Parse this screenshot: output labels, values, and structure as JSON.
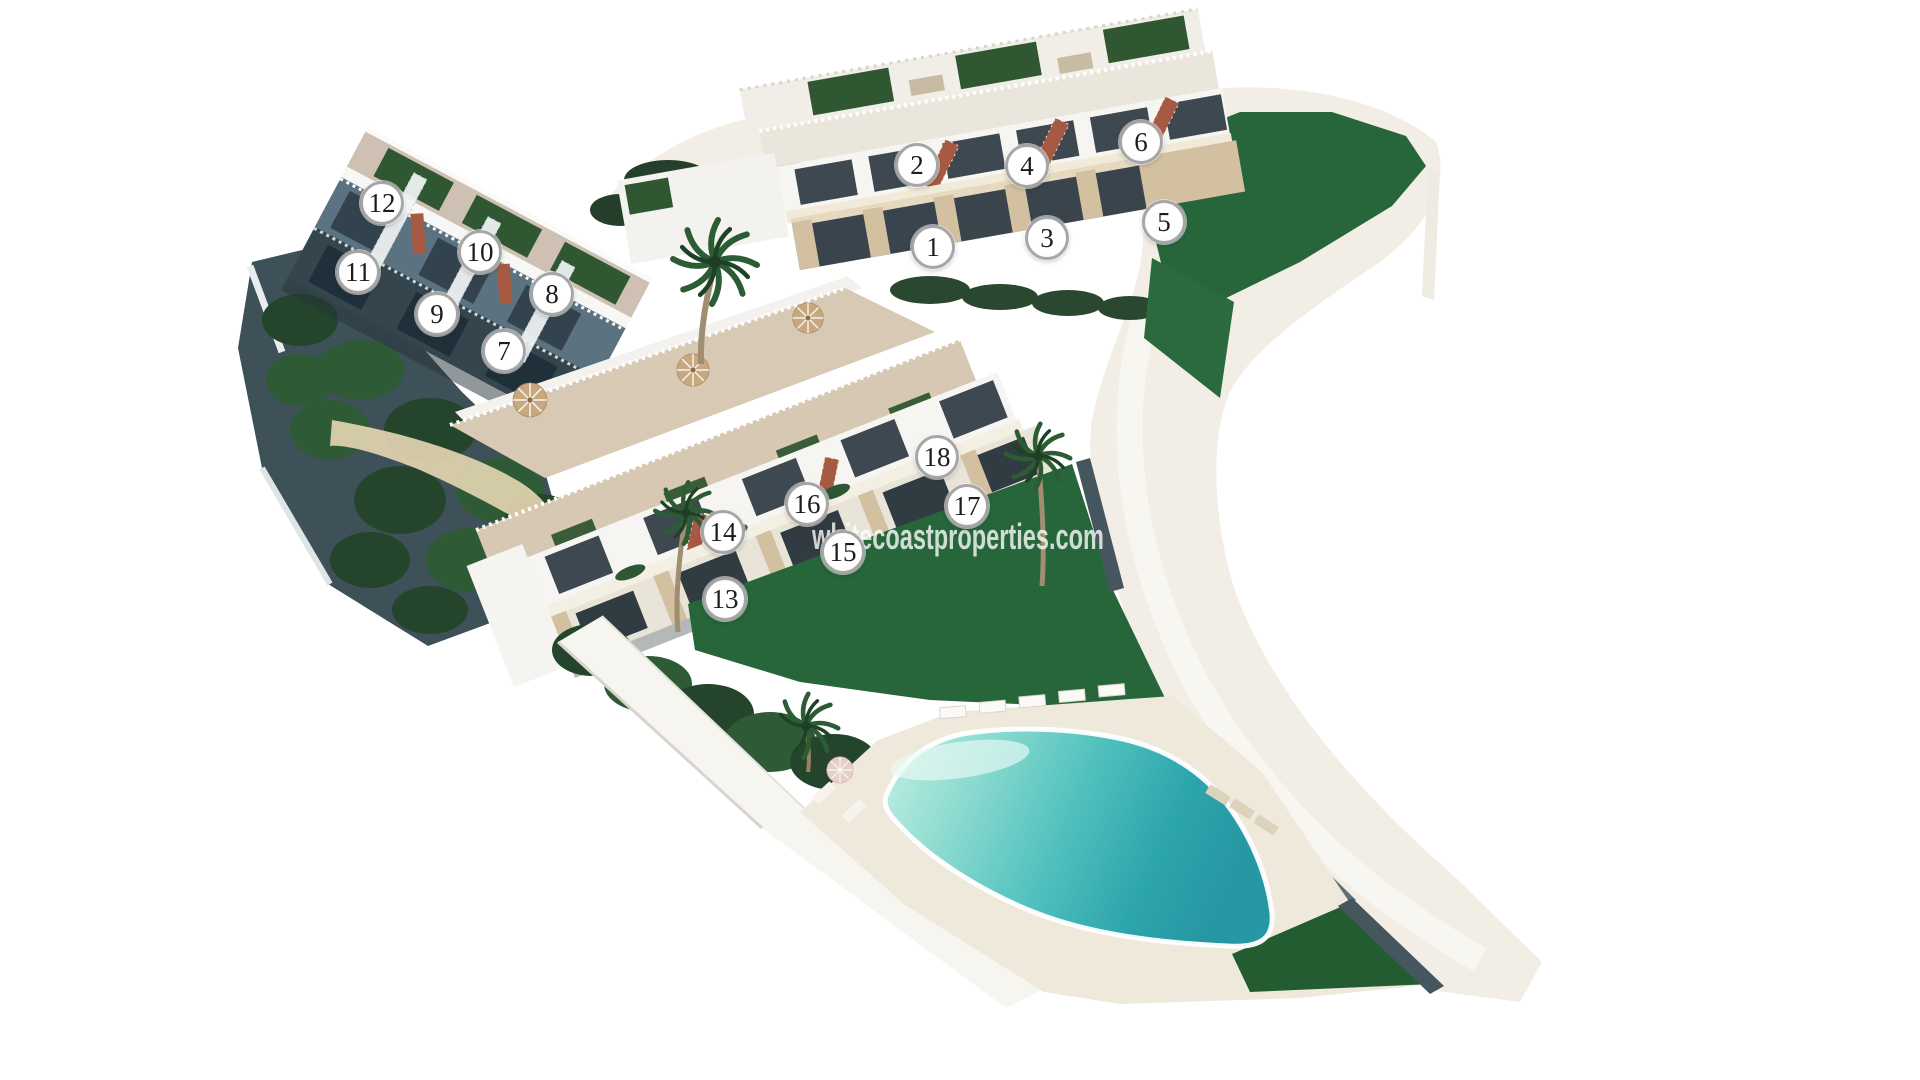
{
  "page": {
    "type": "aerial-3d-site-plan-render",
    "description": "Aerial 3D render of a hillside residential development with three terraced apartment blocks, 18 numbered units, gardens, palm trees, access road and communal swimming pool with sun deck"
  },
  "watermark": {
    "text": "whitecoastproperties.com"
  },
  "site_plan": {
    "unit_count": 18,
    "marker_diameter_px": 44,
    "units": [
      {
        "id": "1",
        "x": 933,
        "y": 247
      },
      {
        "id": "2",
        "x": 917,
        "y": 165
      },
      {
        "id": "3",
        "x": 1047,
        "y": 238
      },
      {
        "id": "4",
        "x": 1027,
        "y": 166
      },
      {
        "id": "5",
        "x": 1164,
        "y": 222
      },
      {
        "id": "6",
        "x": 1141,
        "y": 142
      },
      {
        "id": "7",
        "x": 504,
        "y": 351
      },
      {
        "id": "8",
        "x": 552,
        "y": 294
      },
      {
        "id": "9",
        "x": 437,
        "y": 314
      },
      {
        "id": "10",
        "x": 480,
        "y": 252
      },
      {
        "id": "11",
        "x": 358,
        "y": 272
      },
      {
        "id": "12",
        "x": 382,
        "y": 203
      },
      {
        "id": "13",
        "x": 725,
        "y": 599
      },
      {
        "id": "14",
        "x": 723,
        "y": 532
      },
      {
        "id": "15",
        "x": 843,
        "y": 552
      },
      {
        "id": "16",
        "x": 807,
        "y": 504
      },
      {
        "id": "17",
        "x": 967,
        "y": 506
      },
      {
        "id": "18",
        "x": 937,
        "y": 457
      }
    ],
    "features": [
      "block A units 1-6 (top right)",
      "block B units 7-12 (left)",
      "block C units 13-18 (center)",
      "communal swimming pool",
      "sun deck with loungers and parasols",
      "roof gardens",
      "lawns and hedges",
      "palm trees",
      "curved access road"
    ],
    "palette": {
      "background": "#ffffff",
      "lawn": "#27653a",
      "lawn_wedge": "#2b6a3e",
      "lawn_bottom": "#235c31",
      "roof_garden": "#2f5731",
      "hedge": "#24452b",
      "hedge_light": "#2f5a36",
      "hill_shadow": "#3e5158",
      "building_white": "#f6f5f1",
      "building_shade": "#e9e4d8",
      "glazing": "#3d4851",
      "glazing_dark": "#39444c",
      "stone": "#d3c0a1",
      "gravel": "#d6c8b3",
      "stair_wood": "#a65a43",
      "path": "#f2eee5",
      "deck": "#efe9dc",
      "road_wall": "#46565f",
      "pool_shallow": "#9fe2d8",
      "pool_deep": "#2da5ad",
      "building_b_mid": "#5b7280",
      "building_b_low": "#34454d",
      "marker_ring": "#a6a6a6",
      "marker_fill": "#ffffff",
      "marker_text": "#1c1c1c",
      "watermark_color": "rgba(255,255,255,0.78)"
    }
  }
}
